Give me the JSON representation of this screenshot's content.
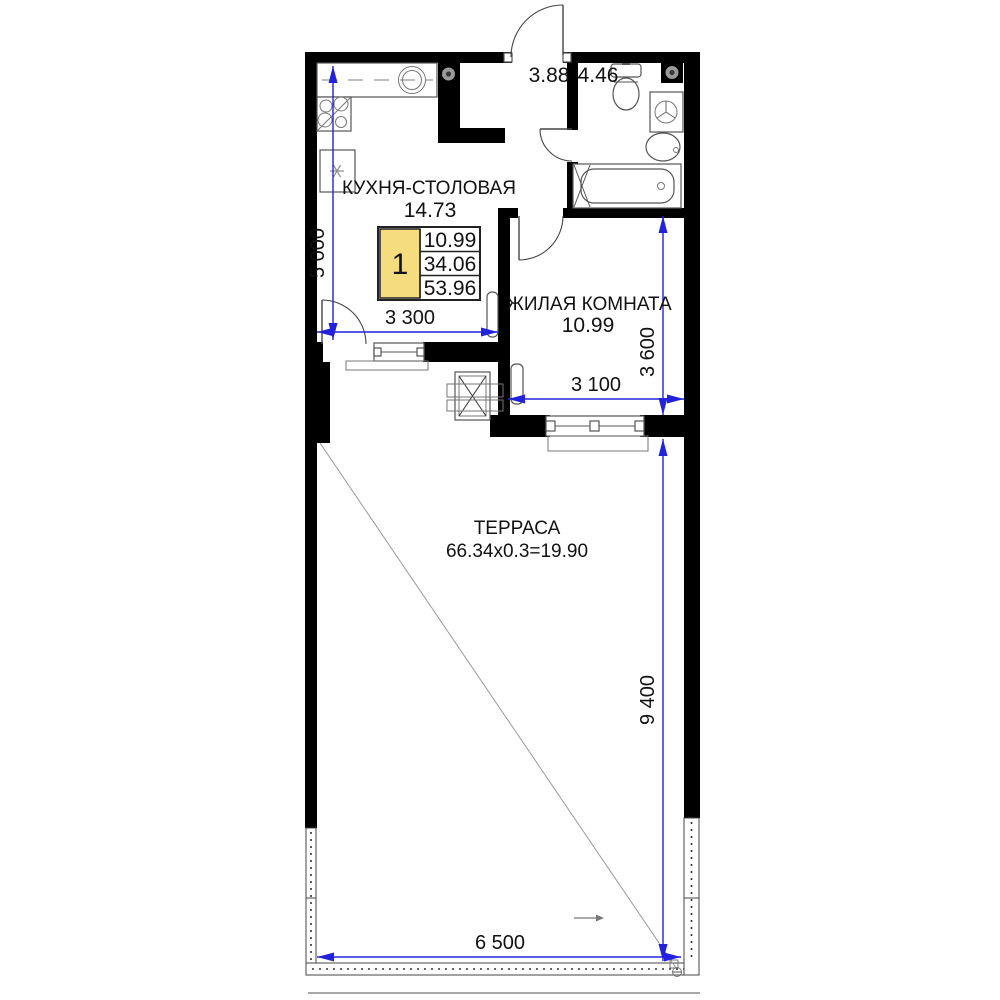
{
  "plan": {
    "rooms": {
      "kitchen": {
        "name": "КУХНЯ-СТОЛОВАЯ",
        "area": "14.73"
      },
      "living": {
        "name": "ЖИЛАЯ КОМНАТА",
        "area": "10.99"
      },
      "terrace": {
        "name": "ТЕРРАСА",
        "area_calc": "66.34x0.3=19.90"
      },
      "hallway": {
        "area": "3.88"
      },
      "bathroom": {
        "area": "4.46"
      }
    },
    "info_table": {
      "rooms_count": "1",
      "living_area": "10.99",
      "apartment_area": "34.06",
      "total_area": "53.96",
      "highlight_color": "#f5dc7e"
    },
    "dimensions": {
      "kitchen_depth": "5 000",
      "kitchen_width": "3 300",
      "living_depth": "3 600",
      "living_width": "3 100",
      "terrace_depth": "9 400",
      "terrace_width": "6 500"
    },
    "colors": {
      "wall": "#000000",
      "dimension": "#2222dd",
      "highlight": "#f5dc7e",
      "fixture_outline": "#555555"
    },
    "fixture_icons": [
      "kitchen-counter",
      "kitchen-sink",
      "stove",
      "fridge",
      "vent",
      "toilet",
      "washing-machine",
      "washbasin",
      "bathtub",
      "radiator",
      "window",
      "door-arc",
      "duct-shaft",
      "terrace-railing"
    ]
  }
}
